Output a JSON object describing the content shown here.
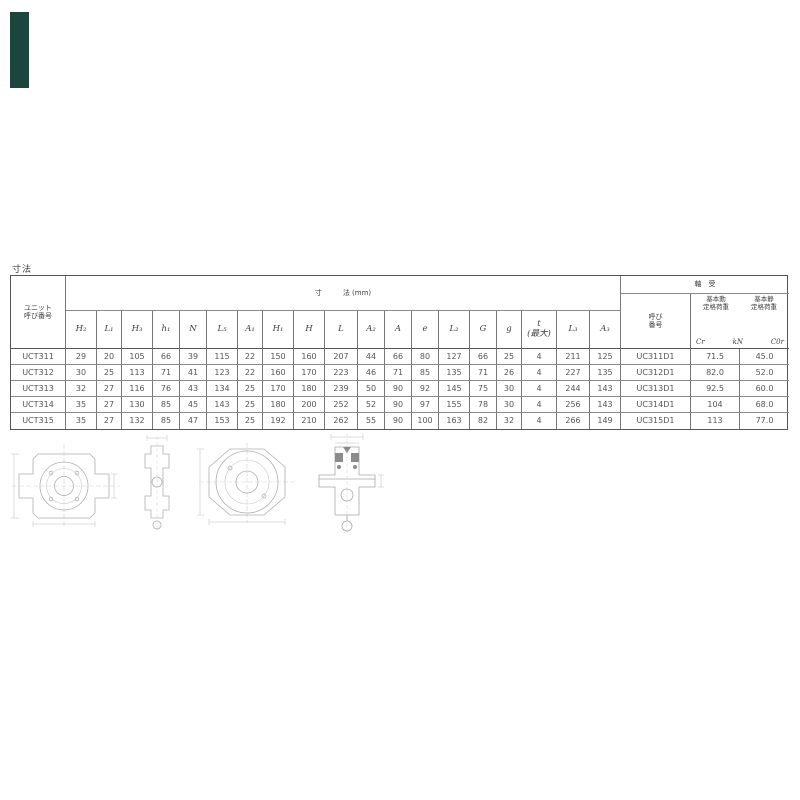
{
  "page": {
    "top_label": "寸法"
  },
  "colors": {
    "brand_bar": "#1b463d",
    "table_line": "#787878",
    "text": "#4a4a4a"
  },
  "table": {
    "unit_col_header": "ユニット\n呼び番号",
    "dim_section_title": "寸　　　法 (mm)",
    "bearing_section_title": "軸　受",
    "bearing_no_header": "呼び\n番号",
    "load": {
      "dynamic": "基本動\n定格荷重",
      "static": "基本静\n定格荷重",
      "cr": "Cr",
      "unit": "kN",
      "cor": "C0r"
    },
    "dim_headers": [
      "H₂",
      "L₁",
      "H₃",
      "h₁",
      "N",
      "L₅",
      "A₁",
      "H₁",
      "H",
      "L",
      "A₂",
      "A",
      "e",
      "L₂",
      "G",
      "g",
      "t\n(最大)",
      "L₃",
      "A₃"
    ],
    "rows": [
      {
        "unit": "UCT311",
        "dims": [
          "29",
          "20",
          "105",
          "66",
          "39",
          "115",
          "22",
          "150",
          "160",
          "207",
          "44",
          "66",
          "80",
          "127",
          "66",
          "25",
          "4",
          "211",
          "125"
        ],
        "bearing": "UC311D1",
        "cr": "71.5",
        "cor": "45.0"
      },
      {
        "unit": "UCT312",
        "dims": [
          "30",
          "25",
          "113",
          "71",
          "41",
          "123",
          "22",
          "160",
          "170",
          "223",
          "46",
          "71",
          "85",
          "135",
          "71",
          "26",
          "4",
          "227",
          "135"
        ],
        "bearing": "UC312D1",
        "cr": "82.0",
        "cor": "52.0"
      },
      {
        "unit": "UCT313",
        "dims": [
          "32",
          "27",
          "116",
          "76",
          "43",
          "134",
          "25",
          "170",
          "180",
          "239",
          "50",
          "90",
          "92",
          "145",
          "75",
          "30",
          "4",
          "244",
          "143"
        ],
        "bearing": "UC313D1",
        "cr": "92.5",
        "cor": "60.0"
      },
      {
        "unit": "UCT314",
        "dims": [
          "35",
          "27",
          "130",
          "85",
          "45",
          "143",
          "25",
          "180",
          "200",
          "252",
          "52",
          "90",
          "97",
          "155",
          "78",
          "30",
          "4",
          "256",
          "143"
        ],
        "bearing": "UC314D1",
        "cr": "104",
        "cor": "68.0"
      },
      {
        "unit": "UCT315",
        "dims": [
          "35",
          "27",
          "132",
          "85",
          "47",
          "153",
          "25",
          "192",
          "210",
          "262",
          "55",
          "90",
          "100",
          "163",
          "82",
          "32",
          "4",
          "266",
          "149"
        ],
        "bearing": "UC315D1",
        "cr": "113",
        "cor": "77.0"
      }
    ]
  }
}
